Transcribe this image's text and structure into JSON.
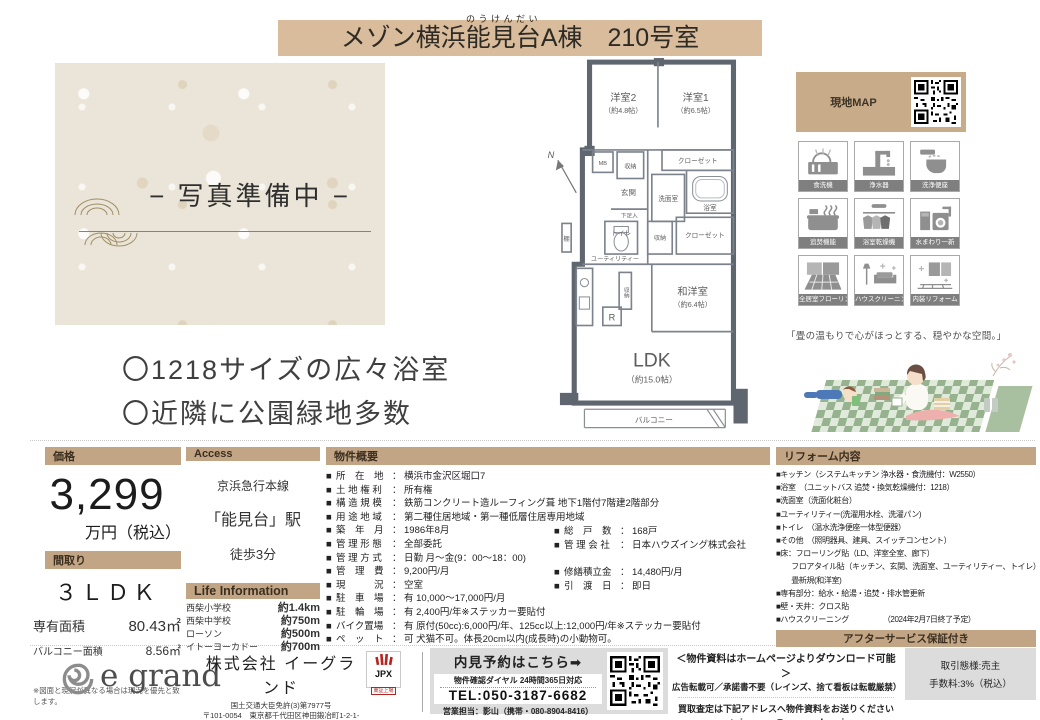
{
  "colors": {
    "title_bar": "#d8bc9c",
    "section_bar": "#c2a585",
    "map_box": "#c8ab88",
    "icon_label": "#7f7f7f",
    "footer_gray": "#dcdcdc",
    "jpx_red": "#b5241f"
  },
  "title": {
    "prefix": "メゾン横浜",
    "ruby_base": "能見台",
    "ruby": "のうけんだい",
    "suffix": "A棟　210号室"
  },
  "photo": {
    "placeholder": "− 写真準備中 −"
  },
  "features": {
    "item1": "〇1218サイズの広々浴室",
    "item2": "〇近隣に公園緑地多数"
  },
  "floorplan": {
    "compass": "N",
    "bed2": "洋室2",
    "bed2_size": "（約4.8帖）",
    "bed1": "洋室1",
    "bed1_size": "（約6.5帖）",
    "closet1": "クローゼット",
    "mb": "MB",
    "storage1": "収納",
    "genkan": "玄関",
    "senmen": "洗面室",
    "bath": "浴室",
    "shoebox": "下足入",
    "toilet": "トイレ",
    "storage2": "収納",
    "closet2": "クローゼット",
    "shelf": "棚",
    "utility": "ユーティリティー",
    "storage3": "収納",
    "fridge": "R",
    "washitsu": "和洋室",
    "washitsu_size": "（約6.4帖）",
    "ldk": "LDK",
    "ldk_size": "（約15.0帖）",
    "balcony": "バルコニー"
  },
  "map_box": {
    "label": "現地MAP"
  },
  "equipment": {
    "items": [
      {
        "label": "食洗機"
      },
      {
        "label": "浄水器"
      },
      {
        "label": "洗浄便座"
      },
      {
        "label": "追焚機能"
      },
      {
        "label": "浴室乾燥機"
      },
      {
        "label": "水まわり一新"
      },
      {
        "label": "全居室フローリング"
      },
      {
        "label": "ハウスクリーニング"
      },
      {
        "label": "内装リフォーム"
      }
    ]
  },
  "quote": "「畳の温もりで心がほっとする、穏やかな空間。」",
  "price": {
    "header": "価格",
    "value": "3,299",
    "unit": "万円（税込）"
  },
  "madori": {
    "header": "間取り",
    "value": "３ＬＤＫ",
    "rows": [
      {
        "label": "専有面積",
        "value": "80.43㎡"
      },
      {
        "label": "バルコニー面積",
        "value": "8.56㎡"
      }
    ],
    "note": "※図面と現況が異なる場合は現況を優先と致します。"
  },
  "access": {
    "header": "Access",
    "line1": "京浜急行本線",
    "line2": "「能見台」駅",
    "line3": "徒歩3分"
  },
  "life": {
    "header": "Life Information",
    "rows": [
      {
        "label": "西柴小学校",
        "value": "約1.4km"
      },
      {
        "label": "西柴中学校",
        "value": "約750m"
      },
      {
        "label": "ローソン",
        "value": "約500m"
      },
      {
        "label": "イトーヨーカドー",
        "value": "約700m"
      }
    ]
  },
  "overview": {
    "header": "物件概要",
    "left": [
      {
        "label": "所　在　地",
        "value": "横浜市金沢区堀口7"
      },
      {
        "label": "土 地 権 利",
        "value": "所有権"
      },
      {
        "label": "構 造 規 模",
        "value": "鉄筋コンクリート造ルーフィング葺 地下1階付7階建2階部分"
      },
      {
        "label": "用 途 地 域",
        "value": "第二種住居地域・第一種低層住居専用地域"
      },
      {
        "label": "築　年　月",
        "value": "1986年8月"
      },
      {
        "label": "管 理 形 態",
        "value": "全部委託"
      },
      {
        "label": "管 理 方 式",
        "value": "日勤 月～金(9：00～18：00)"
      },
      {
        "label": "管　理　費",
        "value": "9,200円/月"
      },
      {
        "label": "現　　　況",
        "value": "空室"
      },
      {
        "label": "駐　車　場",
        "value": "有  10,000～17,000円/月"
      },
      {
        "label": "駐　輪　場",
        "value": "有  2,400円/年※ステッカー要貼付"
      },
      {
        "label": "バイク置場",
        "value": "有  原付(50cc):6,000円/年、125cc以上:12,000円/年※ステッカー要貼付"
      },
      {
        "label": "ペ　ッ　ト",
        "value": "可  犬猫不可。体長20cm以内(成長時)の小動物可。"
      }
    ],
    "right": [
      {
        "label": "総　戸　数",
        "value": "168戸"
      },
      {
        "label": "管 理 会 社",
        "value": "日本ハウズイング株式会社"
      },
      {
        "label": "修繕積立金",
        "value": "14,480円/月"
      },
      {
        "label": "引　渡　日",
        "value": "即日"
      }
    ]
  },
  "reform": {
    "header": "リフォーム内容",
    "items": [
      "■キッチン（システムキッチン 浄水器・食洗機付：W2550）",
      "■浴室　（ユニットバス 追焚・換気乾燥機付：1218）",
      "■洗面室（洗面化粧台）",
      "■ユーティリティー(洗濯用水栓、洗濯パン)",
      "■トイレ　（温水洗浄便座一体型便器）",
      "■その他　（照明器具、建具、スイッチコンセント）",
      "■床：フローリング貼（LD、洋室全室、廊下）",
      "　　フロアタイル貼（キッチン、玄関、洗面室、ユーティリティー、トイレ）",
      "　　畳新規(和洋室)",
      "■専有部分：給水・給湯・追焚・排水管更新",
      "■壁・天井：クロス貼",
      "■ハウスクリーニング　　　　　（2024年2月7日終了予定）"
    ],
    "after_service": "アフターサービス保証付き",
    "code": "物件コード：35-0477"
  },
  "footer": {
    "company": {
      "logo": "e grand",
      "name": "株式会社  イーグランド",
      "license": "国土交通大臣免許(3)第7977号",
      "address": "〒101-0054　東京都千代田区神田鍛冶町1-2-1-7F",
      "hp": "HP：https://e-grand.co.jp FAX:03-3219-5016",
      "jpx": "JPX",
      "jpx_sub": "東証上場"
    },
    "reservation": {
      "title": "内見予約はこちら➡",
      "dial": "物件確認ダイヤル  24時間365日対応",
      "tel": "TEL:050-3187-6682",
      "contact": "営業担当：影山（携帯・080-8904-8416）"
    },
    "notice": {
      "line1": "＜物件資料はホームページよりダウンロード可能＞",
      "line2": "広告転載可／承諾書不要（レインズ、捨て看板は転載厳禁）",
      "line3": "買取査定は下記アドレスへ物件資料をお送りください",
      "line4": "➡toiawase@e-grand.co.jp"
    },
    "deal": {
      "line1": "取引態様:売主",
      "line2": "手数料:3%（税込）"
    }
  }
}
